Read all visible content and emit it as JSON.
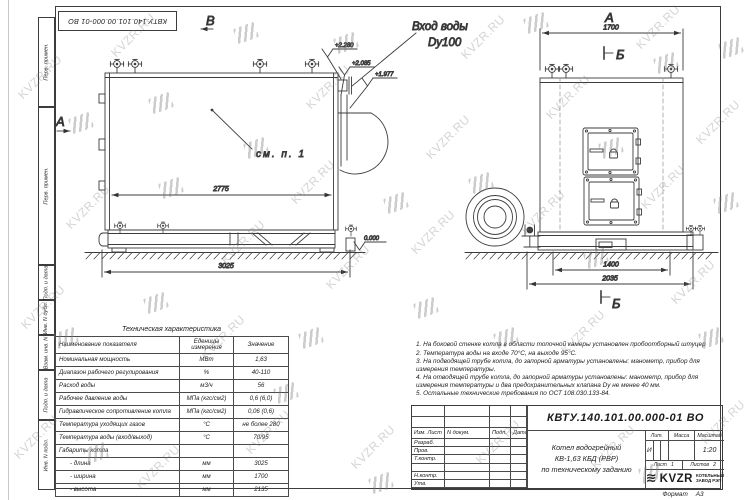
{
  "watermark": {
    "text": "KVZR.RU"
  },
  "stamp_text": "КВТУ.140.101.00.000-01 ВО",
  "margin_labels": [
    "Перв. примен.",
    "Перв. примен.",
    "Подп. и дата",
    "Инв. N дубл.",
    "Взам. инв. N",
    "Подп. и дата",
    "Инв. N подл."
  ],
  "front_view": {
    "label_top": "В",
    "label_left": "А",
    "callout": "см. п. 1",
    "inlet_line1": "Вход воды",
    "inlet_line2": "Dy100",
    "elev1": "+2.280",
    "elev2": "+2.085",
    "elev3": "+1.977",
    "elev0": "0.000",
    "dim_inner": "2775",
    "dim_base": "3025"
  },
  "side_view": {
    "label_top": "А",
    "section_top": "Б",
    "section_bottom": "Б",
    "dim_top": "1700",
    "dim_base": "1400",
    "dim_ground": "2035"
  },
  "spec_table": {
    "title": "Техническая характеристика",
    "headers": [
      "Наименование показателя",
      "Еденицы измерения",
      "Значение"
    ],
    "rows": [
      {
        "name": "Номинальная мощность",
        "unit": "МВт",
        "value": "1,63"
      },
      {
        "name": "Диапазон рабочего регулирования",
        "unit": "%",
        "value": "40-110"
      },
      {
        "name": "Расход воды",
        "unit": "м3/ч",
        "value": "56"
      },
      {
        "name": "Рабочее давление воды",
        "unit": "МПа (кгс/см2)",
        "value": "0,6 (6,0)"
      },
      {
        "name": "Гидравлическое сопротивление котла",
        "unit": "МПа (кгс/см2)",
        "value": "0,06 (0,6)"
      },
      {
        "name": "Температура уходящих газов",
        "unit": "°С",
        "value": "не более 280"
      },
      {
        "name": "Температура воды (вход/выход)",
        "unit": "°С",
        "value": "70/95"
      },
      {
        "name": "Габариты котла",
        "unit": "",
        "value": ""
      },
      {
        "name": "- длина",
        "unit": "мм",
        "value": "3025"
      },
      {
        "name": "- ширина",
        "unit": "мм",
        "value": "1700"
      },
      {
        "name": "- высота",
        "unit": "мм",
        "value": "2135"
      }
    ]
  },
  "notes": [
    "1. На боковой стенке котла в области топочной камеры установлен пробоотборный штуцер",
    "2. Температура воды на входе 70°С, на выходе 95°С.",
    "3. На подводящей трубе котла, до запорной арматуры установлены: манометр, прибор для измерения температуры.",
    "4. На отводящей трубе котла, до запорной арматуры установлены: манометр, прибор для измерения температуры и два предохранительных клапана Dу не менее 40 мм.",
    "5. Остальные технические требования по ОСТ 108.030.133-84."
  ],
  "title_block": {
    "doc_number": "КВТУ.140.101.00.000-01 ВО",
    "product_name_lines": [
      "Котел водогрейный",
      "КВ-1,63 КБД (РВР)",
      "по техническому заданию"
    ],
    "header_cols": [
      "Изм. Лист",
      "N докум.",
      "Подп.",
      "Дата"
    ],
    "row_labels": [
      "Разраб.",
      "Пров.",
      "Т.контр.",
      "",
      "Н.контр.",
      "Утв."
    ],
    "lit_header": "Лит.",
    "lit_value": "И",
    "mass_header": "Масса",
    "mass_value": "",
    "scale_header": "Масштаб",
    "scale_value": "1:20",
    "sheet_label": "Лист",
    "sheet_number": "1",
    "sheets_label": "Листов",
    "sheets_total": "2",
    "logo_icon": "≋",
    "logo_text": "KVZR",
    "logo_sub1": "КОТЕЛЬНЫЙ",
    "logo_sub2": "ЗАВОД РЭП",
    "format_label": "Формат",
    "format_value": "А3"
  }
}
